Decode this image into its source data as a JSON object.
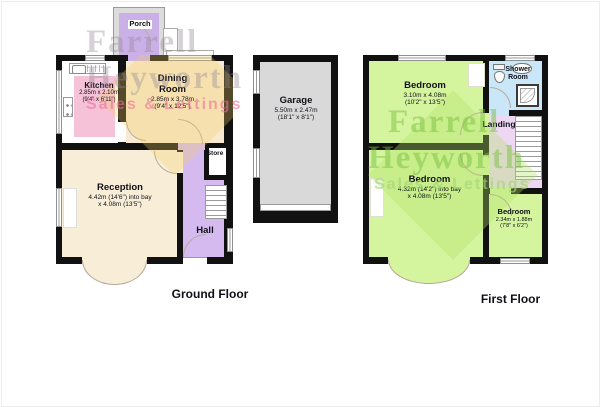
{
  "floors": {
    "ground": {
      "label": "Ground Floor",
      "rooms": {
        "porch": {
          "name": "Porch"
        },
        "kitchen": {
          "name": "Kitchen",
          "dim_m": "2.85m x 2.10m",
          "dim_ft": "(9'4\" x 6'11\")"
        },
        "dining": {
          "name1": "Dining",
          "name2": "Room",
          "dim_m": "2.85m x 3.78m",
          "dim_ft": "(9'4\" x 12'5\")"
        },
        "reception": {
          "name": "Reception",
          "dim1": "4.42m (14'6\") into bay",
          "dim2": "x 4.08m (13'5\")"
        },
        "hall": {
          "name": "Hall"
        },
        "store": {
          "name": "Store"
        }
      }
    },
    "garage": {
      "rooms": {
        "garage": {
          "name": "Garage",
          "dim_m": "5.50m x 2.47m",
          "dim_ft": "(18'1\" x 8'1\")"
        }
      }
    },
    "first": {
      "label": "First Floor",
      "rooms": {
        "bedroom1": {
          "name": "Bedroom",
          "dim_m": "3.10m x 4.08m",
          "dim_ft": "(10'2\" x 13'5\")"
        },
        "shower": {
          "name1": "Shower",
          "name2": "Room"
        },
        "landing": {
          "name": "Landing"
        },
        "bedroom2": {
          "name": "Bedroom",
          "dim1": "4.32m (14'2\") into bay",
          "dim2": "x 4.08m (13'5\")"
        },
        "bedroom3": {
          "name": "Bedroom",
          "dim_m": "2.34m x 1.88m",
          "dim_ft": "(7'8\" x 6'2\")"
        }
      }
    }
  },
  "watermark": {
    "line1": "Farrell",
    "line2": "Heyworth",
    "line3": "Sales & Lettings"
  },
  "colors": {
    "wall": "#111111",
    "kitchen_floor": "#f6c2d8",
    "dining": "#f8ead0",
    "reception": "#f8eed8",
    "hall": "#d5baf0",
    "porch": "#cbb0e8",
    "bedroom": "#d4f49e",
    "shower": "#c9e7f8",
    "landing": "#eed7f3",
    "garage": "#d9d9d9",
    "watermark_gray": "#968c96",
    "watermark_pink": "#ec6e96",
    "watermark_green": "#78be3c"
  }
}
